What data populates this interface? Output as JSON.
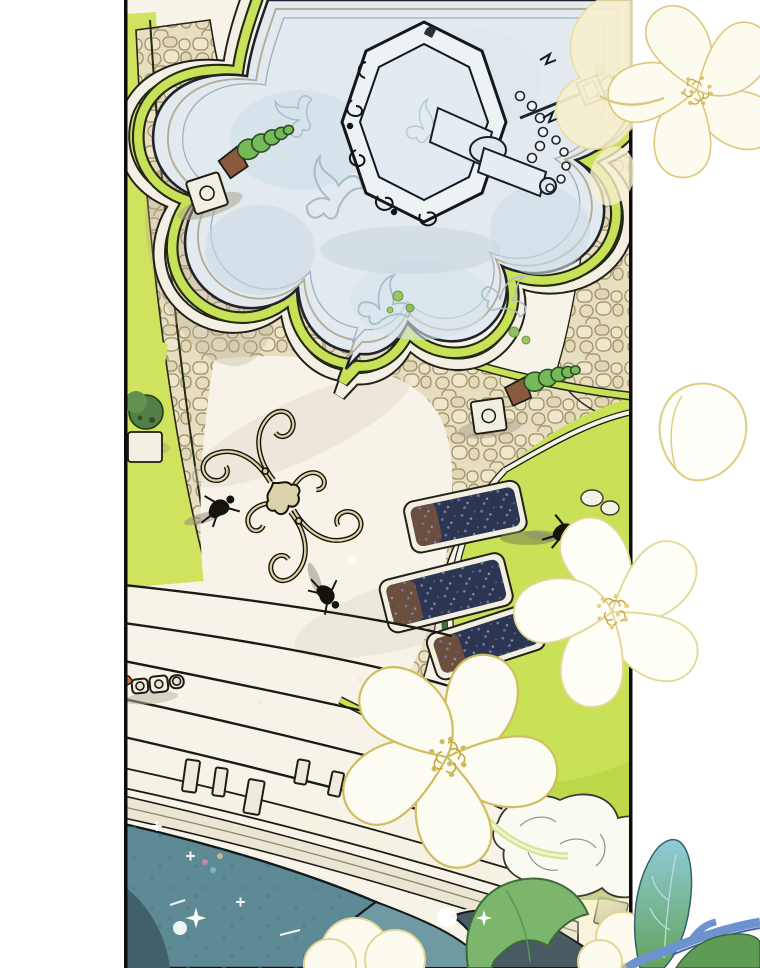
{
  "meta": {
    "kind": "webtoon-panel-illustration",
    "description": "Bird's-eye watercolor illustration of a palace garden: a flower-shaped pale-blue marble plaza with an ornate tiered fountain at top, cobblestone paths bordered by lime hedges, bright lawns with navy flowerbeds, a baroque scroll inlay, tiny pedestrians, wide curved steps with balustrade leading down to teal rooftops, a marble statue, and translucent yellow-outlined flowers and leaves overlaid across the panel borders."
  },
  "palette": {
    "paper": "#ffffff",
    "ink": "#14130e",
    "panel_cream": "#f7f3e8",
    "plaza_blue": "#e2eaef",
    "plaza_shade": "#c9d7e0",
    "rim_tan": "#b9b29d",
    "rim_blue": "#9fb2bf",
    "cobble_base": "#e7ddc0",
    "cobble_stone_light": "#eee5ca",
    "cobble_stone_dark": "#e0d6b4",
    "cobble_line": "#9c8e66",
    "hedge_lime": "#c8e159",
    "hedge_lime_deep": "#a9cf43",
    "hedge_ink": "#232a12",
    "lawn": "#c9e156",
    "lawn_speckle": "#a6ca39",
    "bed_navy": "#2c3652",
    "bed_speckle": "#7584ad",
    "soil_brown": "#6b4e3d",
    "stone_white": "#f5f1e3",
    "stone_cornice": "#ebe6d4",
    "stone_gray": "#c9c4b2",
    "step_ink": "#1b1b16",
    "roof_teal": "#5e8a95",
    "roof_teal_light": "#6f99a3",
    "roof_teal_dark": "#41606c",
    "roof_slate": "#4a5a62",
    "marble_white": "#fbfaf2",
    "topiary_green": "#74ba58",
    "topiary_dark": "#2c4a22",
    "pot_brown": "#8a5a3e",
    "flower_fill": "#fdfcf2",
    "flower_outline": "#d0bd60",
    "flower_outline_pale": "#e2d794",
    "flower_cream": "#f7f0cf",
    "stamen_gold": "#c9a43e",
    "leaf_green": "#7cb66c",
    "leaf_dark": "#396838",
    "stem_blue": "#6d93cf",
    "figure_ink": "#16130c",
    "glow_yellow": "#fbf3bf",
    "shadow_grey": "#b5ad97"
  },
  "scene": {
    "elements": [
      {
        "name": "panel-border-left",
        "label": "black panel border"
      },
      {
        "name": "panel-border-right",
        "label": "black panel border"
      },
      {
        "name": "flower-plaza",
        "label": "flower-shaped pale blue marble plaza"
      },
      {
        "name": "fountain",
        "label": "ornate octagonal fountain with tilted tiered column and spout"
      },
      {
        "name": "cobblestone-paths",
        "label": "beige cobblestone walkways"
      },
      {
        "name": "hedge-borders",
        "label": "lime hedge strips with stone edging"
      },
      {
        "name": "topiary-cone-1",
        "label": "spiral cone topiary on pedestal"
      },
      {
        "name": "topiary-cone-2",
        "label": "spiral cone topiary on pedestal"
      },
      {
        "name": "topiary-bush",
        "label": "dark round shrub on pedestal"
      },
      {
        "name": "lawn",
        "label": "bright yellow-green lawn"
      },
      {
        "name": "flowerbeds",
        "label": "curved navy flowerbeds with soil ends"
      },
      {
        "name": "ornament-inlay",
        "label": "baroque scroll pavement inlay"
      },
      {
        "name": "pedestrians",
        "label": "three tiny figures seen from above"
      },
      {
        "name": "garden-bench",
        "label": "small ornate bench near steps"
      },
      {
        "name": "curved-steps",
        "label": "wide concentric garden steps"
      },
      {
        "name": "balustrade",
        "label": "balustrade with posts and pillars"
      },
      {
        "name": "roof-teal",
        "label": "teal palace rooftop"
      },
      {
        "name": "roof-slate",
        "label": "dark slate rooftop"
      },
      {
        "name": "marble-statue",
        "label": "white marble sculpture group"
      },
      {
        "name": "overlay-flowers",
        "label": "yellow-outlined white flowers drawn over the panel"
      },
      {
        "name": "overlay-leaves",
        "label": "blue-green leaves and branch in foreground corner"
      },
      {
        "name": "sparkles",
        "label": "white sparkle stars and bokeh dots"
      }
    ]
  }
}
